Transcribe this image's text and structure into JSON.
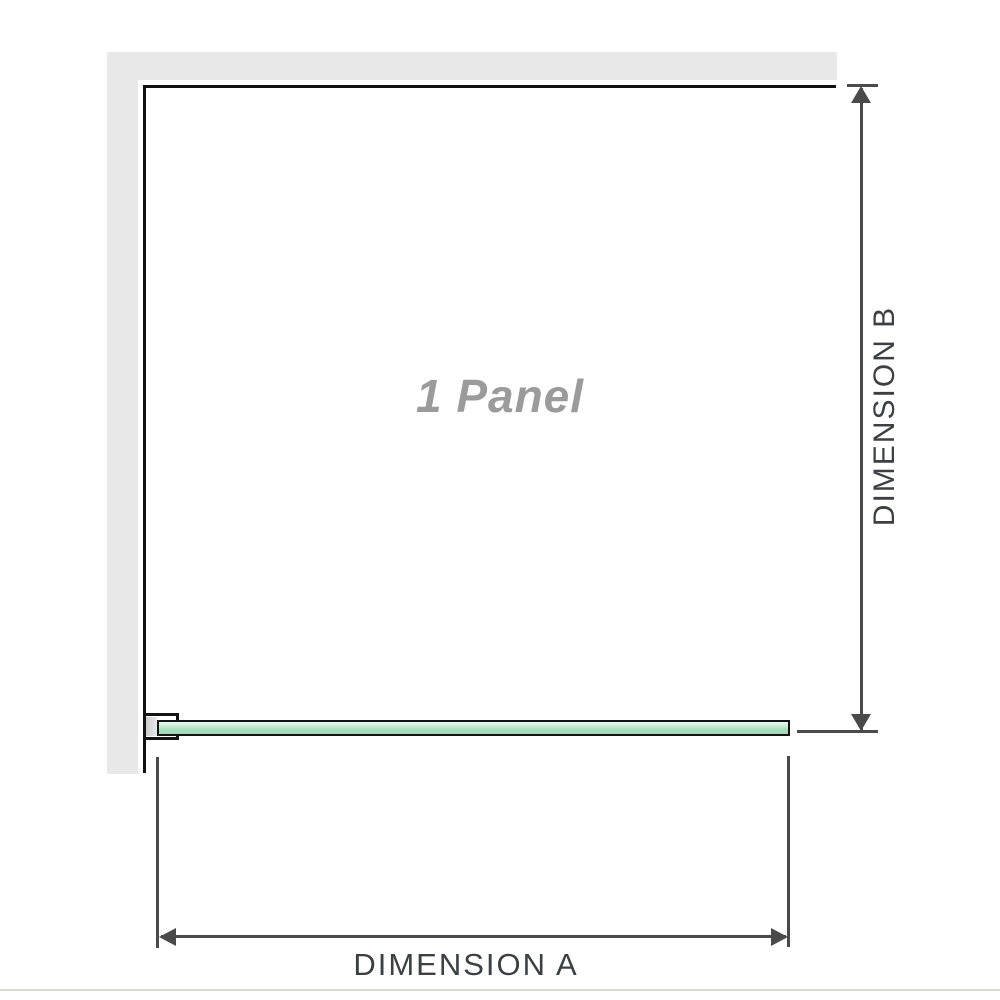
{
  "diagram": {
    "panel_label": "1 Panel",
    "dimension_a_label": "DIMENSION A",
    "dimension_b_label": "DIMENSION B"
  },
  "colors": {
    "background": "#ffffff",
    "wall_gray": "#e8e8e8",
    "panel_outline_black": "#111111",
    "glass_green": "#abdfbf",
    "glass_highlight": "#e9f8f0",
    "glass_border": "#131313",
    "bracket_block_gray": "#cccccc",
    "dimension_line_gray": "#4a4a4a",
    "dimension_text_gray": "#3d4043",
    "panel_label_gray": "#9b9b9b",
    "bottom_rule": "#dbd7d1"
  }
}
